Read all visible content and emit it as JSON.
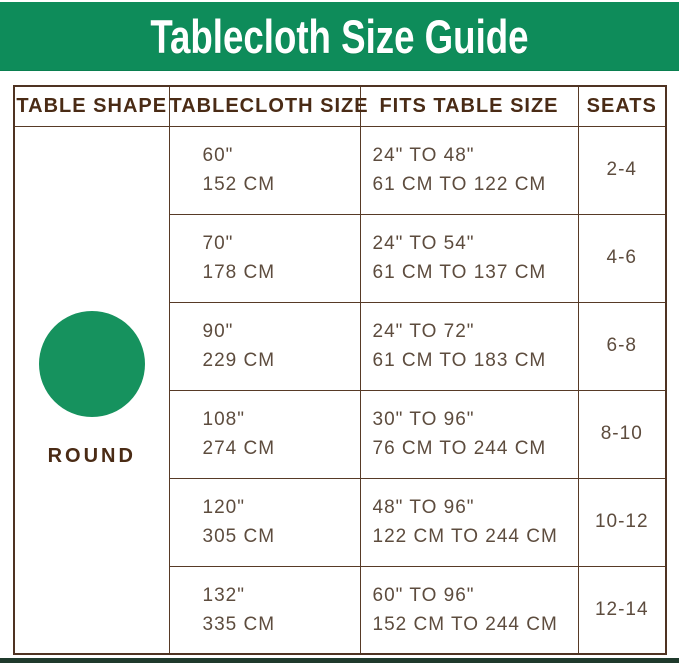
{
  "title": "Tablecloth Size Guide",
  "colors": {
    "banner_green": "#0e8c5a",
    "circle_green": "#16925e",
    "header_text_brown": "#4a2b15",
    "body_text_brown": "#5d4c3e",
    "border_brown": "#573a26",
    "bottom_bar_green": "#1f3a2c"
  },
  "table": {
    "headers": {
      "shape": "TABLE SHAPE",
      "size": "TABLECLOTH SIZE",
      "fits": "FITS TABLE SIZE",
      "seats": "SEATS"
    },
    "shape": {
      "icon": "circle",
      "label": "ROUND"
    },
    "rows": [
      {
        "size_in": "60\"",
        "size_cm": "152 CM",
        "fits_in": "24\" TO 48\"",
        "fits_cm": "61 CM TO 122 CM",
        "seats": "2-4"
      },
      {
        "size_in": "70\"",
        "size_cm": "178 CM",
        "fits_in": "24\" TO 54\"",
        "fits_cm": "61 CM TO 137 CM",
        "seats": "4-6"
      },
      {
        "size_in": "90\"",
        "size_cm": "229 CM",
        "fits_in": "24\" TO 72\"",
        "fits_cm": "61 CM TO 183 CM",
        "seats": "6-8"
      },
      {
        "size_in": "108\"",
        "size_cm": "274 CM",
        "fits_in": "30\" TO 96\"",
        "fits_cm": "76 CM TO 244 CM",
        "seats": "8-10"
      },
      {
        "size_in": "120\"",
        "size_cm": "305 CM",
        "fits_in": "48\" TO 96\"",
        "fits_cm": "122 CM TO 244 CM",
        "seats": "10-12"
      },
      {
        "size_in": "132\"",
        "size_cm": "335 CM",
        "fits_in": "60\" TO 96\"",
        "fits_cm": "152 CM TO 244 CM",
        "seats": "12-14"
      }
    ]
  }
}
